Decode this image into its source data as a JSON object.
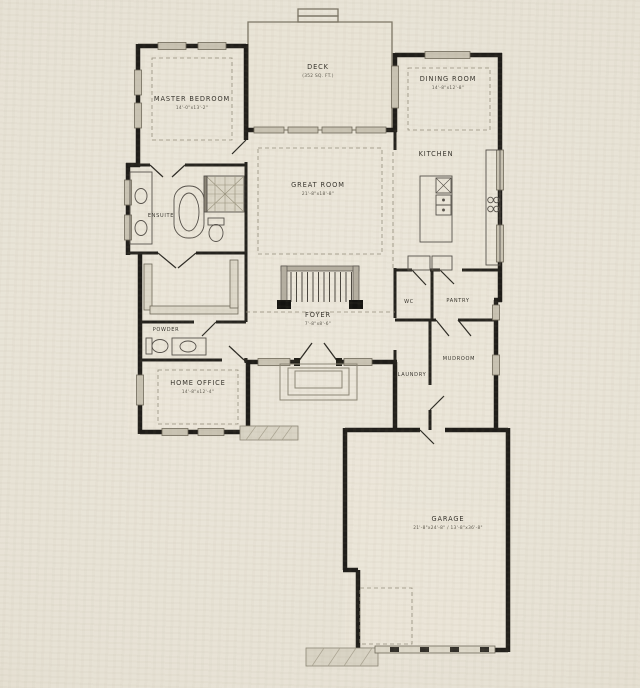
{
  "sheet": {
    "type": "floor-plan-drawing"
  },
  "colors": {
    "paper": "#e8e3d7",
    "wall": "#1f1d19",
    "thin_line": "#6e6859",
    "window_fill": "#c9c3b3",
    "dashed_line": "#958f7e",
    "label_text": "#35322b"
  },
  "rooms": {
    "master_bedroom": {
      "label": "MASTER BEDROOM",
      "dims": "14'-0\"x13'-2\""
    },
    "deck": {
      "label": "DECK",
      "dims": "(352 SQ. FT.)"
    },
    "dining_room": {
      "label": "DINING ROOM",
      "dims": "14'-8\"x12'-8\""
    },
    "kitchen": {
      "label": "KITCHEN"
    },
    "great_room": {
      "label": "GREAT ROOM",
      "dims": "21'-8\"x18'-8\""
    },
    "ensuite": {
      "label": "ENSUITE"
    },
    "powder": {
      "label": "POWDER"
    },
    "foyer": {
      "label": "FOYER",
      "dims": "7'-8\"x8'-6\""
    },
    "home_office": {
      "label": "HOME OFFICE",
      "dims": "14'-8\"x12'-4\""
    },
    "wc": {
      "label": "WC"
    },
    "pantry": {
      "label": "PANTRY"
    },
    "mudroom": {
      "label": "MUDROOM"
    },
    "laundry": {
      "label": "LAUNDRY"
    },
    "garage": {
      "label": "GARAGE",
      "dims": "21'-8\"x24'-8\" / 13'-8\"x36'-8\""
    }
  }
}
